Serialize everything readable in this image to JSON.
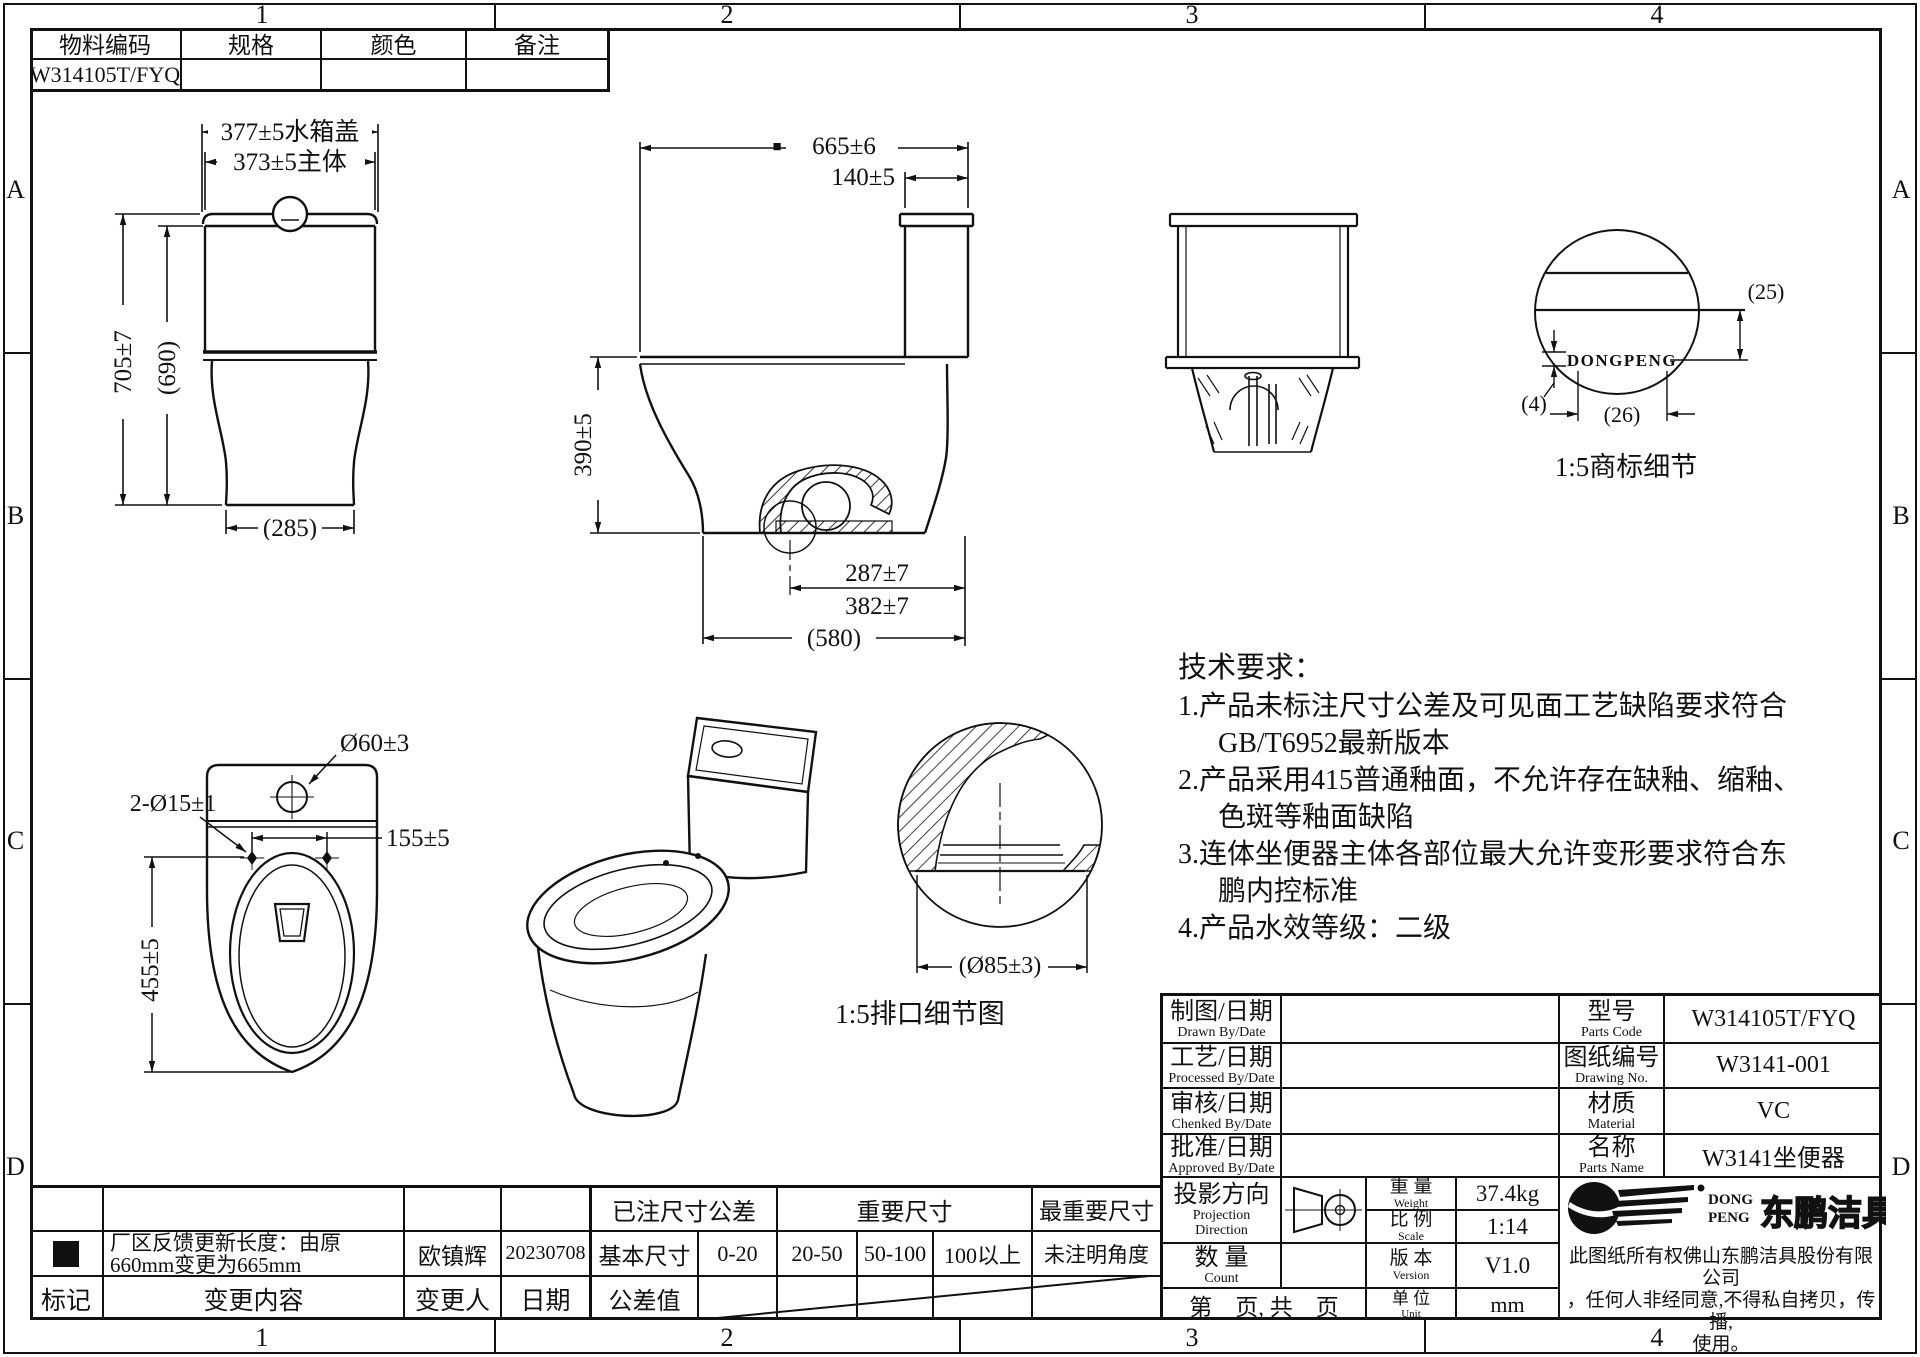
{
  "zones": {
    "top": [
      "1",
      "2",
      "3",
      "4"
    ],
    "bottom": [
      "1",
      "2",
      "3",
      "4"
    ],
    "left": [
      "A",
      "B",
      "C",
      "D"
    ],
    "right": [
      "A",
      "B",
      "C",
      "D"
    ]
  },
  "info_table": {
    "headers": [
      "物料编码",
      "规格",
      "颜色",
      "备注"
    ],
    "row": [
      "W314105T/FYQ",
      "",
      "",
      ""
    ]
  },
  "front_view": {
    "dim_lid": "377±5水箱盖",
    "dim_body": "373±5主体",
    "dim_total_height": "705±7",
    "dim_ref_height": "(690)",
    "dim_base_width": "(285)"
  },
  "side_view": {
    "marker": "■",
    "dim_total_length": "665±6",
    "dim_tank_depth": "140±5",
    "dim_rim_height": "390±5",
    "dim_trap_1": "287±7",
    "dim_trap_2": "382±7",
    "dim_base_length": "(580)"
  },
  "trademark_detail": {
    "logo_text": "DONGPENG",
    "dim_height": "(25)",
    "dim_gap": "(4)",
    "dim_width": "(26)",
    "caption": "1:5商标细节"
  },
  "top_view": {
    "dim_spud": "Ø60±3",
    "dim_seat_holes": "2-Ø15±1",
    "dim_hole_pitch": "155±5",
    "dim_length": "455±5"
  },
  "outlet_detail": {
    "dim_diameter": "(Ø85±3)",
    "caption": "1:5排口细节图"
  },
  "tech_requirements": {
    "title": "技术要求：",
    "lines": [
      "1.产品未标注尺寸公差及可见面工艺缺陷要求符合",
      "GB/T6952最新版本",
      "2.产品采用415普通釉面，不允许存在缺釉、缩釉、",
      "色斑等釉面缺陷",
      "3.连体坐便器主体各部位最大允许变形要求符合东",
      "鹏内控标准",
      "4.产品水效等级：二级"
    ]
  },
  "title_block": {
    "drawn": {
      "cn": "制图/日期",
      "en": "Drawn By/Date"
    },
    "processed": {
      "cn": "工艺/日期",
      "en": "Processed By/Date"
    },
    "checked": {
      "cn": "审核/日期",
      "en": "Chenked By/Date"
    },
    "approved": {
      "cn": "批准/日期",
      "en": "Approved By/Date"
    },
    "model": {
      "cn": "型号",
      "en": "Parts Code",
      "value": "W314105T/FYQ"
    },
    "drawing_no": {
      "cn": "图纸编号",
      "en": "Drawing No.",
      "value": "W3141-001"
    },
    "material": {
      "cn": "材质",
      "en": "Material",
      "value": "VC"
    },
    "name": {
      "cn": "名称",
      "en": "Parts Name",
      "value": "W3141坐便器"
    },
    "projection": {
      "cn": "投影方向",
      "en1": "Projection",
      "en2": "Direction"
    },
    "weight": {
      "cn": "重 量",
      "en": "Weight",
      "value": "37.4kg"
    },
    "scale": {
      "cn": "比 例",
      "en": "Scale",
      "value": "1:14"
    },
    "count": {
      "cn": "数 量",
      "en": "Count",
      "value": ""
    },
    "version": {
      "cn": "版 本",
      "en": "Version",
      "value": "V1.0"
    },
    "unit": {
      "cn": "单 位",
      "en": "Unit",
      "value": "mm"
    },
    "page": "第　页, 共　页",
    "brand": {
      "en1": "DONG",
      "en2": "PENG",
      "cn": "东鹏洁具"
    },
    "disclaimer": [
      "此图纸所有权佛山东鹏洁具股份有限公司",
      "，任何人非经同意,不得私自拷贝，传播,",
      "使用。"
    ]
  },
  "revision_table": {
    "headers": {
      "mark": "标记",
      "content": "变更内容",
      "person": "变更人",
      "date": "日期"
    },
    "rows": [
      {
        "mark": "■",
        "content1": "厂区反馈更新长度：由原",
        "content2": "660mm变更为665mm",
        "person": "欧镇辉",
        "date": "20230708"
      }
    ]
  },
  "tolerance_table": {
    "noted": "已注尺寸公差",
    "important": "重要尺寸",
    "most_important": "最重要尺寸",
    "basic_label": "基本尺寸",
    "ranges": [
      "0-20",
      "20-50",
      "50-100",
      "100以上",
      "未注明角度"
    ],
    "tolerance_label": "公差值"
  }
}
